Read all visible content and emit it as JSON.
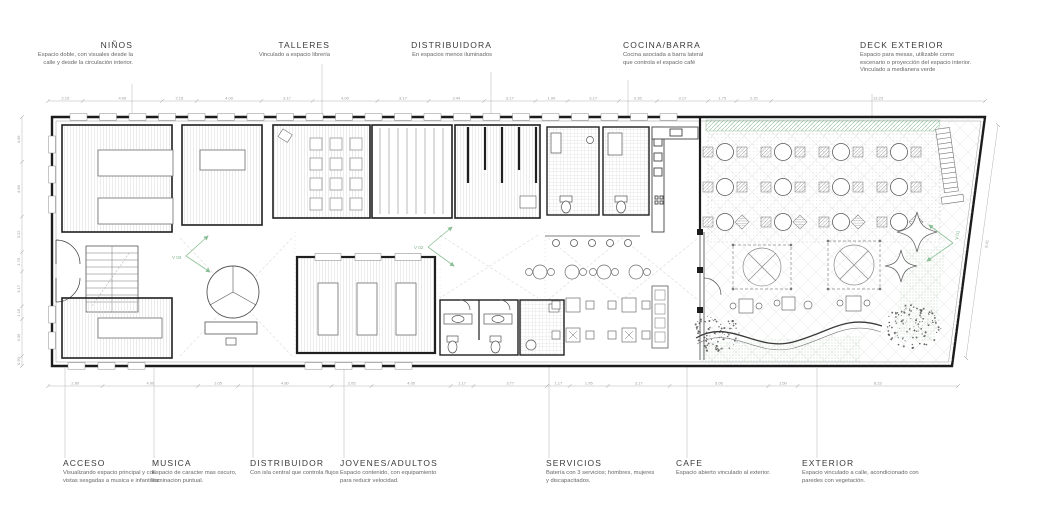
{
  "colors": {
    "wall": "#1c1c1c",
    "hatch": "#d6d6d6",
    "leader": "#c9c9c9",
    "dim_text": "#9a9a9a",
    "green_marker": "#7ab387",
    "green_hatch": "#8fbf99",
    "title_text": "#3a3a3a",
    "caption_text": "#666666"
  },
  "annotations": {
    "top": [
      {
        "id": "ninos",
        "title": "NIÑOS",
        "caption": "Espacio doble, con visuales desde la calle y desde la circulación interior."
      },
      {
        "id": "talleres",
        "title": "TALLERES",
        "caption": "Vinculado a espacio librería"
      },
      {
        "id": "distribuidora",
        "title": "DISTRIBUIDORA",
        "caption": "En espacios menos iluminados"
      },
      {
        "id": "cocina-barra",
        "title": "COCINA/BARRA",
        "caption": "Cocina asociada a barra lateral que controla el espacio café"
      },
      {
        "id": "deck-exterior",
        "title": "DECK EXTERIOR",
        "caption": "Espacio para mesas, utilizable como escenario o proyección del espacio interior.\nVinculado a medianera verde"
      }
    ],
    "bottom": [
      {
        "id": "acceso",
        "title": "ACCESO",
        "caption": "Visualizando espacio principal y con vistas sesgadas a musica e infantiles."
      },
      {
        "id": "musica",
        "title": "MUSICA",
        "caption": "Espacio de caracter mas oscuro, iluminacion puntual."
      },
      {
        "id": "distribuidor",
        "title": "DISTRIBUIDOR",
        "caption": "Con isla central que controla flujos"
      },
      {
        "id": "jovenes-adultos",
        "title": "JOVENES/ADULTOS",
        "caption": "Espacio contenido, con equipamiento para reducir velocidad."
      },
      {
        "id": "servicios",
        "title": "SERVICIOS",
        "caption": "Batería con 3 servicios; hombres, mujeres y discapacitados."
      },
      {
        "id": "cafe",
        "title": "CAFE",
        "caption": "Espacio abierto vinculado al exterior."
      },
      {
        "id": "exterior",
        "title": "EXTERIOR",
        "caption": "Espacio vinculado a calle, acondicionado con paredes con vegetación."
      }
    ]
  },
  "view_markers": [
    {
      "label": "V 01"
    },
    {
      "label": "V 02"
    },
    {
      "label": "V 03"
    }
  ],
  "dimensions": {
    "top": [
      "2.15",
      "4.90",
      "2.15",
      "4.00",
      "3.17",
      "4.00",
      "3.17",
      "3.44",
      "3.17",
      "1.99",
      "3.17",
      "2.35",
      "3.17",
      "1.75",
      "2.15",
      "13.23"
    ],
    "bottom": [
      "2.80",
      "4.90",
      "2.05",
      "4.80",
      "2.05",
      "4.05",
      "1.17",
      "3.77",
      "1.17",
      "1.95",
      "3.17",
      "5.06",
      "1.50",
      "8.23"
    ],
    "left": [
      "4.06",
      "4.98",
      "3.22",
      "1.75",
      "3.17",
      "1.15",
      "3.36",
      "0.90"
    ],
    "right": [
      "8.41"
    ]
  }
}
